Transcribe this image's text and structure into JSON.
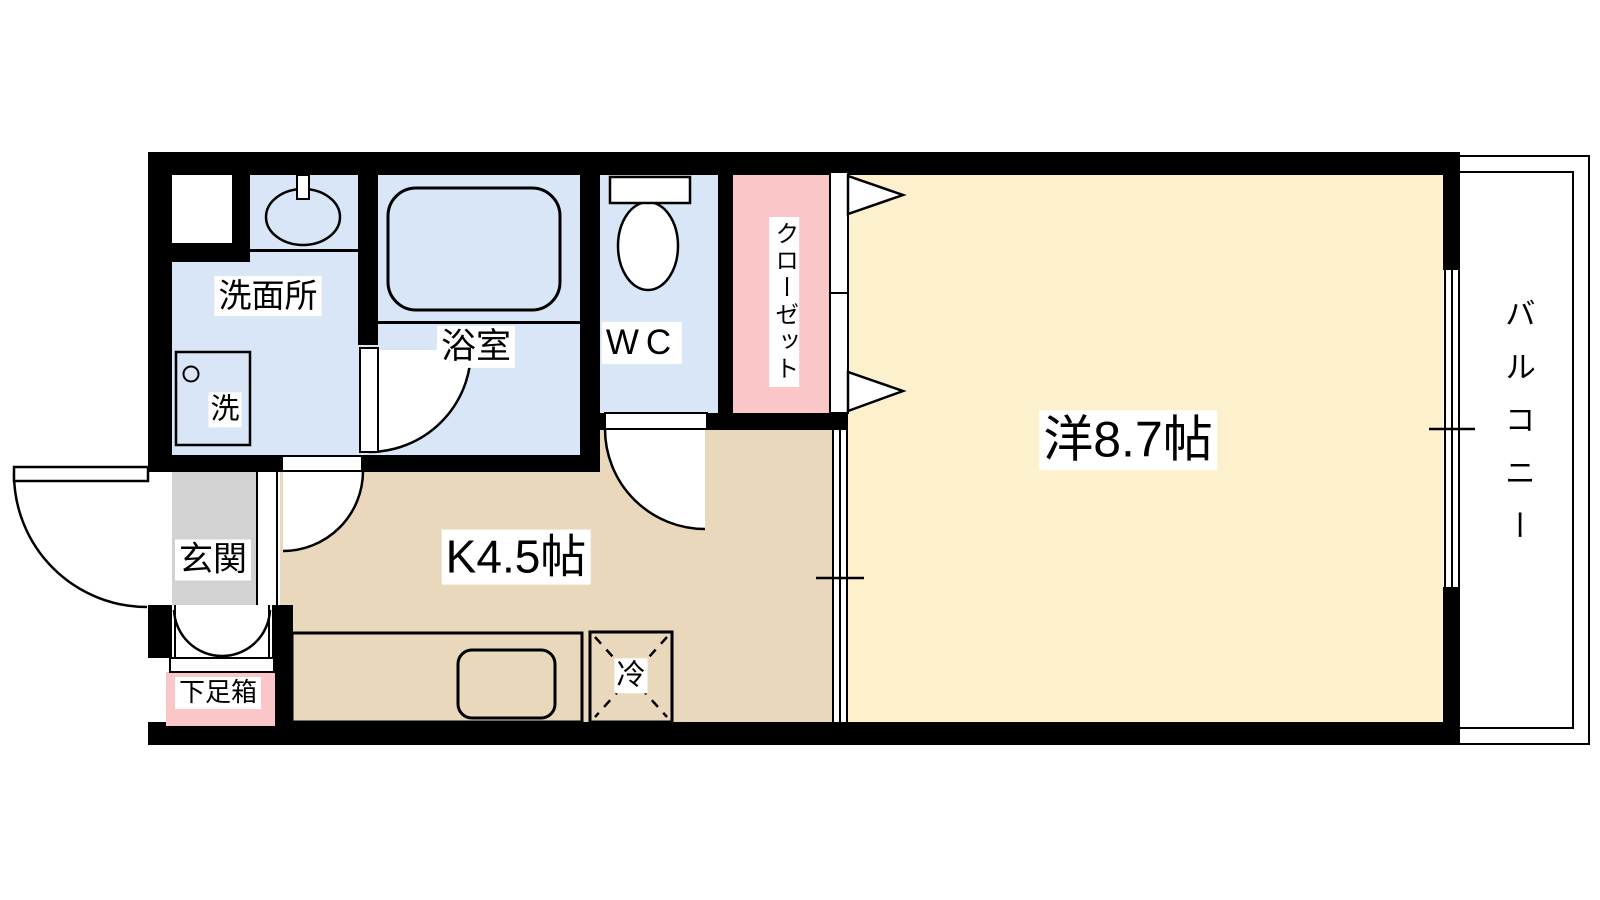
{
  "floorplan": {
    "type": "apartment-floor-plan-1K",
    "rooms": {
      "washroom": {
        "label": "洗面所"
      },
      "bathroom": {
        "label": "浴室"
      },
      "toilet_room": {
        "label": "WC"
      },
      "closet": {
        "label": "クローゼット"
      },
      "western_room": {
        "label": "洋8.7帖",
        "size_jo": 8.7
      },
      "kitchen": {
        "label": "K4.5帖",
        "size_jo": 4.5
      },
      "entrance": {
        "label": "玄関"
      },
      "shoe_box": {
        "label": "下足箱"
      },
      "balcony": {
        "label": "バルコニー"
      }
    },
    "fixtures": {
      "refrigerator": {
        "label": "冷"
      },
      "washing_machine": {
        "label": "洗"
      }
    },
    "colors": {
      "wet_area_blue": "#d8e6f7",
      "closet_pink": "#fac6c8",
      "room_cream": "#fcf0cd",
      "kitchen_tan": "#e9d8bc",
      "entrance_gray": "#d2d2d2",
      "wall_black": "#000000"
    }
  }
}
